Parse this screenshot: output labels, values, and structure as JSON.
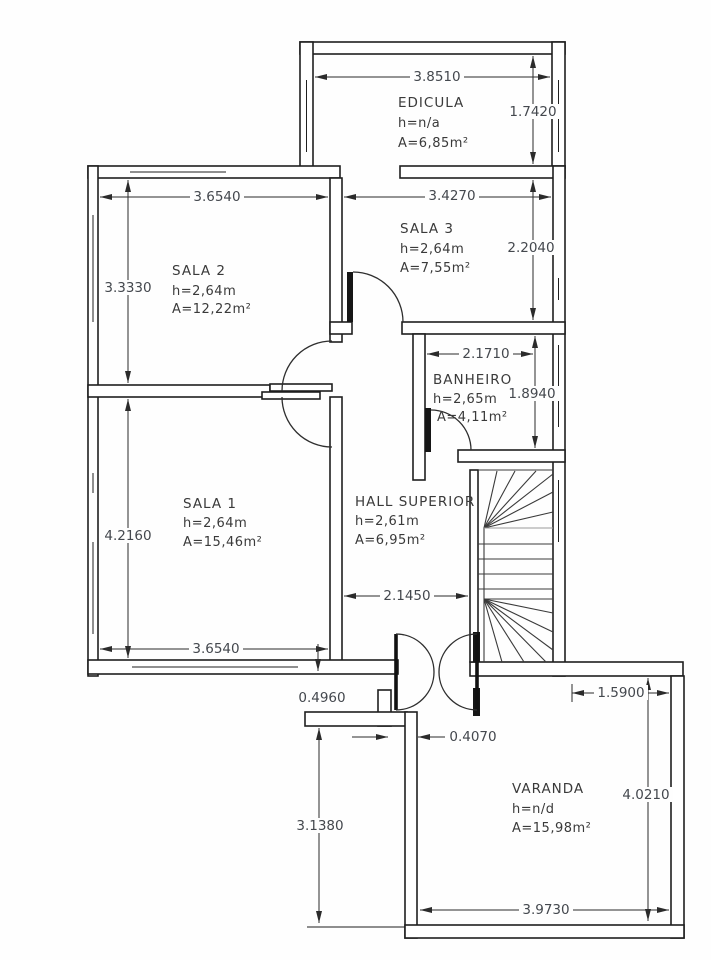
{
  "colors": {
    "background": "#fefefe",
    "wall_line": "#1f1f1f",
    "dimension_text": "#44484e",
    "room_text": "#3a3a3a"
  },
  "rooms": {
    "edicula": {
      "name": "EDICULA",
      "h": "h=n/a",
      "a": "A=6,85m²"
    },
    "sala3": {
      "name": "SALA 3",
      "h": "h=2,64m",
      "a": "A=7,55m²"
    },
    "sala2": {
      "name": "SALA 2",
      "h": "h=2,64m",
      "a": "A=12,22m²"
    },
    "banheiro": {
      "name": "BANHEIRO",
      "h": "h=2,65m",
      "a": "A=4,11m²"
    },
    "sala1": {
      "name": "SALA 1",
      "h": "h=2,64m",
      "a": "A=15,46m²"
    },
    "hall": {
      "name": "HALL SUPERIOR",
      "h": "h=2,61m",
      "a": "A=6,95m²"
    },
    "varanda": {
      "name": "VARANDA",
      "h": "h=n/d",
      "a": "A=15,98m²"
    }
  },
  "dims": {
    "edicula_width": "3.8510",
    "edicula_depth": "1.7420",
    "sala2_width": "3.6540",
    "sala3_width": "3.4270",
    "sala2_depth": "3.3330",
    "sala3_depth": "2.2040",
    "banheiro_width": "2.1710",
    "banheiro_depth": "1.8940",
    "sala1_depth": "4.2160",
    "sala1_width": "3.6540",
    "hall_width": "2.1450",
    "wall_offset": "0.4960",
    "door_offset": "0.4070",
    "terrace_depth": "3.1380",
    "varanda_top": "1.5900",
    "varanda_depth": "4.0210",
    "varanda_width": "3.9730"
  }
}
